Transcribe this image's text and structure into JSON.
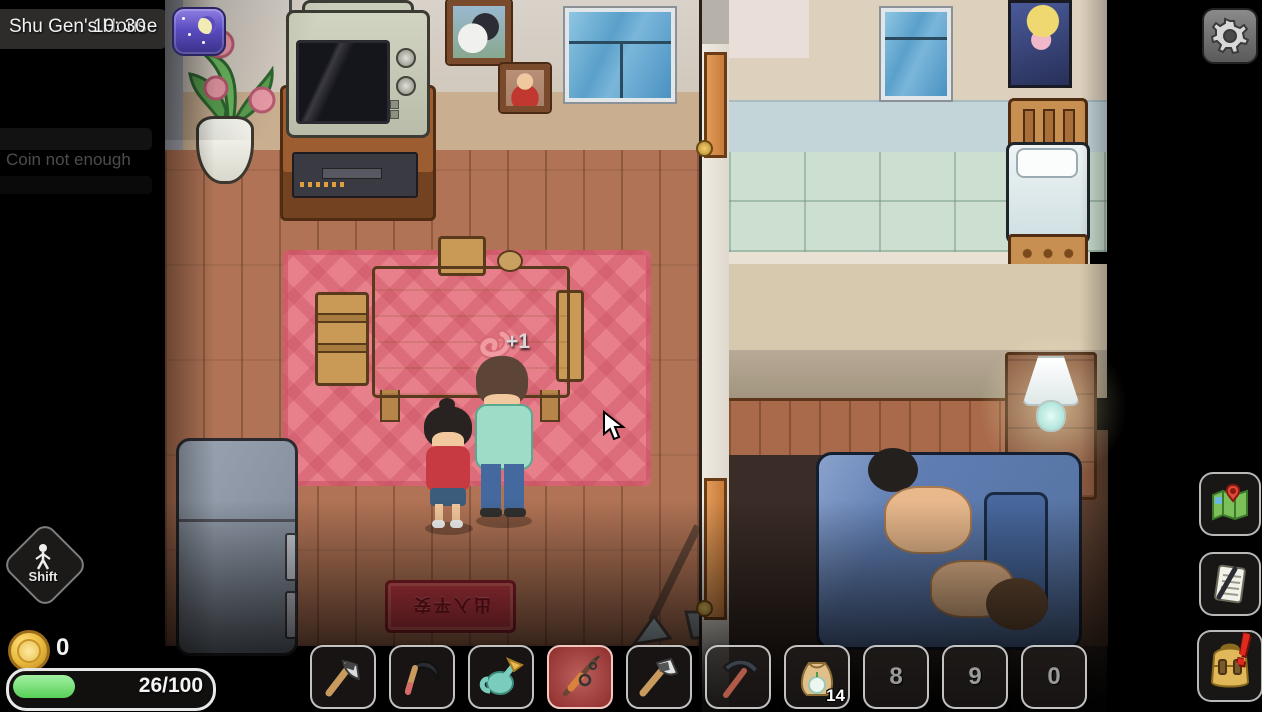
{
  "hud": {
    "location_label": "Shu Gen's House",
    "time": "10: 30",
    "toast_message": "Coin not enough",
    "shift_key_label": "Shift",
    "coin_count": "0",
    "energy_bar": {
      "value": 26,
      "max": 100,
      "text": "26/100",
      "fill_percent": 31,
      "fill_color": "#7ce57c"
    },
    "buttons": {
      "settings_icon": "gear-icon",
      "map_icon": "map-icon",
      "journal_icon": "notes-icon",
      "inventory_icon": "backpack-icon",
      "inventory_alert": "!"
    },
    "time_of_day": "night"
  },
  "hotbar": {
    "selected_index": 3,
    "slots": [
      {
        "item": "hatchet"
      },
      {
        "item": "sickle"
      },
      {
        "item": "watering-can"
      },
      {
        "item": "fishing-rod",
        "selected": true
      },
      {
        "item": "axe"
      },
      {
        "item": "pickaxe"
      },
      {
        "item": "seed-bag",
        "count": "14"
      },
      {
        "item": "empty",
        "label": "8"
      },
      {
        "item": "empty",
        "label": "9"
      },
      {
        "item": "empty",
        "label": "0"
      }
    ]
  },
  "scene": {
    "pickup_popup": "+1",
    "doormat_text": "出入平安",
    "colors": {
      "selected_slot_red": "#d96a66",
      "energy_green": "#7ce57c",
      "coin_gold": "#e8b83a",
      "rug_pink": "#e8808c",
      "doormat_red": "#c23a44",
      "floor_wood": "#b07355",
      "night_badge_purple": "#5a4cc0"
    }
  }
}
